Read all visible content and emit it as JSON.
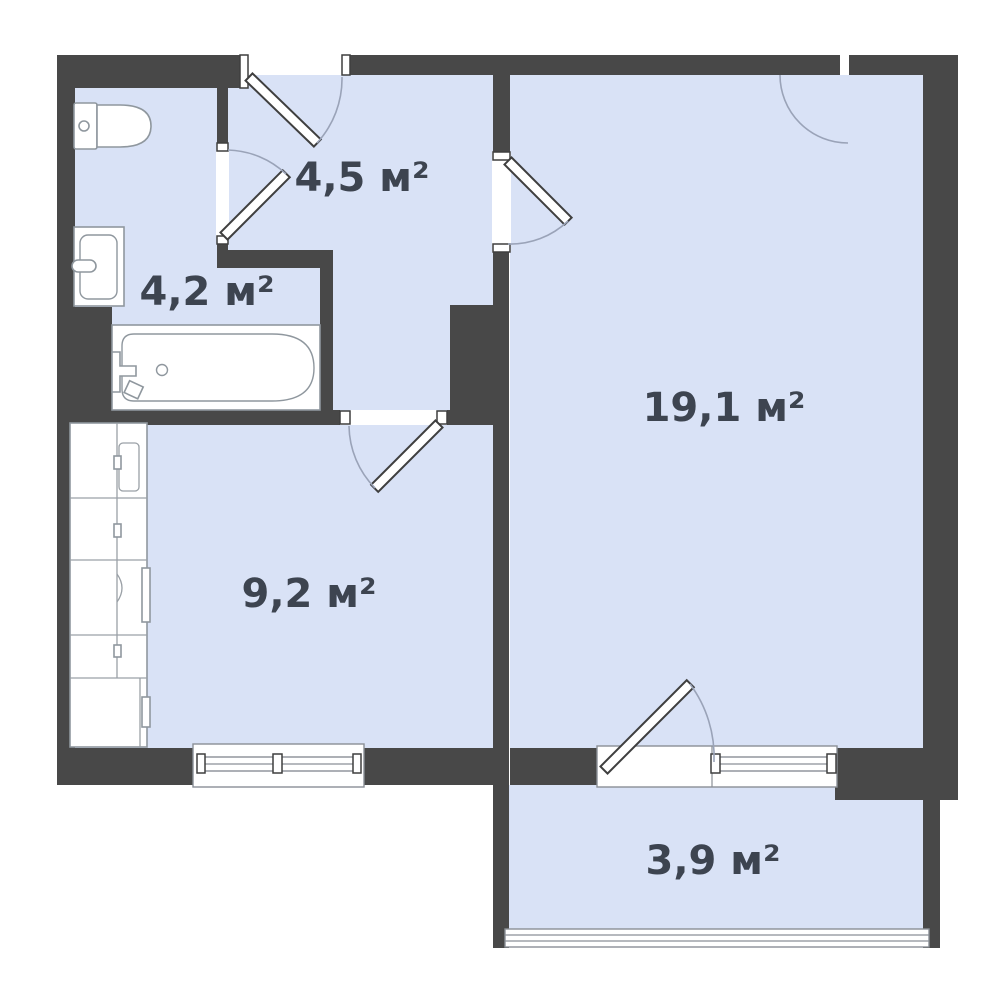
{
  "title": "Apartment floor plan",
  "colors": {
    "wall": "#484848",
    "floor": "#d9e2f6",
    "fixture_stroke": "#8f979e",
    "swing_arc": "#9aa3b8",
    "label_text": "#3d4450",
    "background": "#ffffff"
  },
  "rooms": [
    {
      "id": "hallway",
      "area_label": "4,5 м²"
    },
    {
      "id": "bathroom",
      "area_label": "4,2 м²"
    },
    {
      "id": "living-room",
      "area_label": "19,1 м²"
    },
    {
      "id": "kitchen",
      "area_label": "9,2 м²"
    },
    {
      "id": "balcony",
      "area_label": "3,9 м²"
    }
  ]
}
